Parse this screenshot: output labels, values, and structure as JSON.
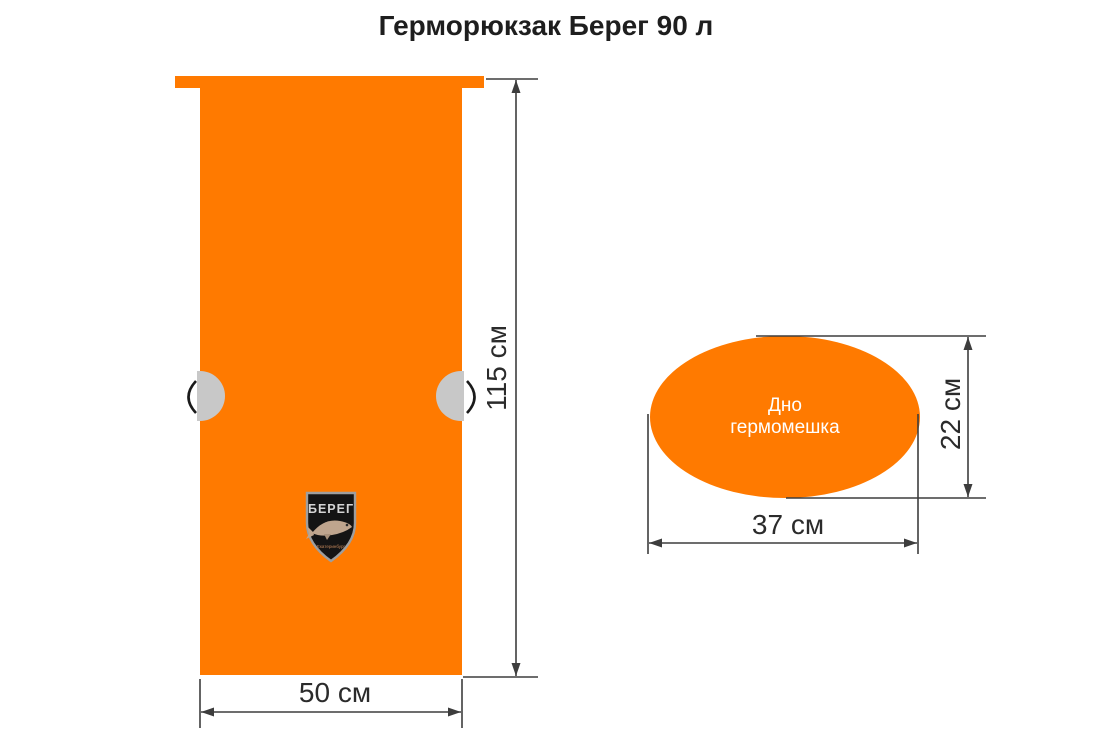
{
  "title": "Герморюкзак Берег 90 л",
  "front_view": {
    "height_label": "115 см",
    "width_label": "50 см"
  },
  "bottom_view": {
    "label": "Дно гермомешка",
    "height_label": "22 см",
    "width_label": "37 см"
  },
  "logo": {
    "brand": "БЕРЕГ",
    "city": "Екатеринбург"
  },
  "colors": {
    "bag_orange": "#FF7A00",
    "clip_grey": "#C8C8C8",
    "dimension_line": "#3D3D3D",
    "text_dark": "#2B2B2B",
    "shield_black": "#141414",
    "shield_border": "#9E9E9E",
    "fish_tan": "#BFA58E",
    "label_white": "#FFFFFF"
  }
}
